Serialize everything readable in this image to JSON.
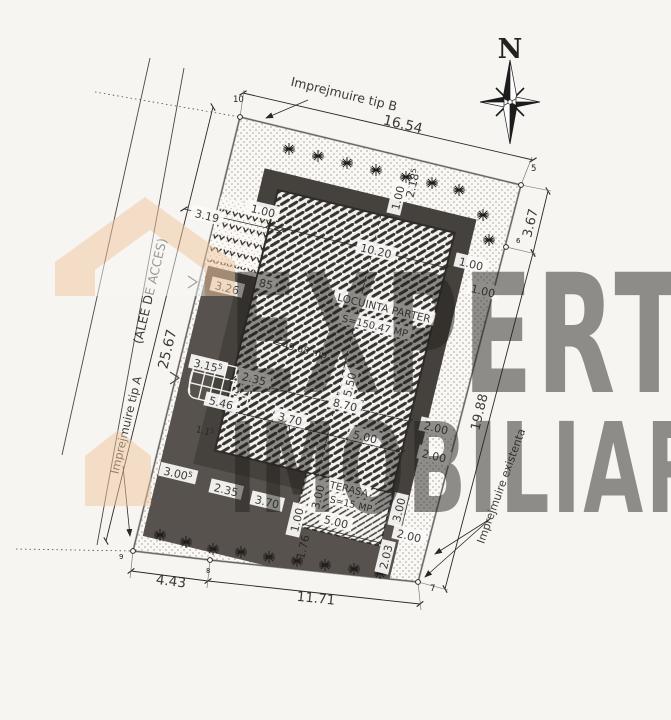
{
  "watermark": {
    "line1": "EXPERT",
    "line2": "IMOBILIAR",
    "color": "#eec49c"
  },
  "compass": {
    "north_label": "N"
  },
  "plan": {
    "building": {
      "name": "LOCUINTA PARTER",
      "area_label": "S=150.47 MP"
    },
    "terrace": {
      "name": "TERASA",
      "area_label": "S=15 MP"
    },
    "labels": [
      {
        "n": "dim-16-54",
        "t": "16.54",
        "x": 403,
        "y": 124,
        "fs": 14
      },
      {
        "n": "label-fence-b",
        "t": "Imprejmuire tip B",
        "x": 344,
        "y": 94,
        "fs": 12.5
      },
      {
        "n": "dim-25-67",
        "t": "25.67",
        "x": 167,
        "y": 349,
        "r": -76.5,
        "fs": 14
      },
      {
        "n": "label-alley",
        "t": "(ALEE DE ACCES)",
        "x": 150,
        "y": 291,
        "r": -76.5,
        "fs": 12.5
      },
      {
        "n": "label-fence-a",
        "t": "Imprejmuire tip A",
        "x": 126,
        "y": 425,
        "r": -76.5,
        "fs": 11.5
      },
      {
        "n": "dim-3-67",
        "t": "3.67",
        "x": 530,
        "y": 223,
        "r": -76.5,
        "fs": 13
      },
      {
        "n": "dim-19-88",
        "t": "19.88",
        "x": 479,
        "y": 412,
        "r": -76.5,
        "fs": 13
      },
      {
        "n": "label-fence-existing",
        "t": "Imprejmuire existenta",
        "x": 501,
        "y": 486,
        "r": -70,
        "fs": 11
      },
      {
        "n": "dim-4-43",
        "t": "4.43",
        "x": 171,
        "y": 581,
        "r": 7,
        "fs": 13.5
      },
      {
        "n": "dim-11-71",
        "t": "11.71",
        "x": 316,
        "y": 598,
        "r": 6,
        "fs": 13.5
      },
      {
        "n": "dim-3-19",
        "t": "3.19",
        "x": 207,
        "y": 216,
        "box": true
      },
      {
        "n": "dim-1-00-a",
        "t": "1.00",
        "x": 263,
        "y": 211,
        "box": true
      },
      {
        "n": "dim-3-26",
        "t": "3.26",
        "x": 227,
        "y": 288,
        "box": true
      },
      {
        "n": "dim-0-85",
        "t": "85",
        "x": 266,
        "y": 284,
        "box": true
      },
      {
        "n": "dim-10-20",
        "t": "10.20",
        "x": 376,
        "y": 251,
        "box": true
      },
      {
        "n": "dim-1-00-b",
        "t": "1.00",
        "x": 398,
        "y": 198,
        "r": -76.5,
        "box": true
      },
      {
        "n": "dim-2-185",
        "t": "2.18",
        "sup": "5",
        "x": 413,
        "y": 183,
        "r": -76.5
      },
      {
        "n": "dim-1-00-c",
        "t": "1.00",
        "x": 471,
        "y": 264,
        "box": true
      },
      {
        "n": "dim-1-00-d",
        "t": "1.00",
        "x": 483,
        "y": 291,
        "box": true
      },
      {
        "n": "building-name",
        "t": "LOCUINTA PARTER",
        "x": 384,
        "y": 308,
        "fs": 10.5,
        "box": true
      },
      {
        "n": "building-area",
        "t": "S=150.47 MP",
        "x": 375,
        "y": 326,
        "fs": 10,
        "box": true
      },
      {
        "n": "area-faint",
        "t": "=49.68 mp",
        "x": 301,
        "y": 349,
        "fs": 9.5,
        "faint": true
      },
      {
        "n": "dim-15-50",
        "t": "15.50",
        "x": 349,
        "y": 388,
        "r": -76.5,
        "box": true
      },
      {
        "n": "dim-8-70",
        "t": "8.70",
        "x": 345,
        "y": 405,
        "box": true
      },
      {
        "n": "dim-3-70-a",
        "t": "3.70",
        "x": 290,
        "y": 419,
        "box": true
      },
      {
        "n": "dim-5-00-a",
        "t": "5.00",
        "x": 365,
        "y": 437,
        "box": true
      },
      {
        "n": "dim-2-00-a",
        "t": "2.00",
        "x": 436,
        "y": 428,
        "box": true
      },
      {
        "n": "dim-2-00-b",
        "t": "2.00",
        "x": 434,
        "y": 456,
        "box": true
      },
      {
        "n": "terrace-name",
        "t": "TERASA",
        "x": 349,
        "y": 489,
        "fs": 10,
        "box": true
      },
      {
        "n": "terrace-area",
        "t": "S=15 MP",
        "x": 351,
        "y": 504,
        "fs": 9.5,
        "box": true
      },
      {
        "n": "dim-3-00-a",
        "t": "3.00",
        "x": 318,
        "y": 497,
        "r": -76.5,
        "box": true
      },
      {
        "n": "dim-3-00-b",
        "t": "3.00",
        "x": 399,
        "y": 510,
        "r": -76.5,
        "box": true
      },
      {
        "n": "dim-2-00-c",
        "t": "2.00",
        "x": 409,
        "y": 536,
        "box": true
      },
      {
        "n": "dim-5-00-b",
        "t": "5.00",
        "x": 336,
        "y": 522,
        "box": true
      },
      {
        "n": "dim-1-00-e",
        "t": "1.00",
        "x": 297,
        "y": 520,
        "r": -76.5,
        "box": true
      },
      {
        "n": "dim-1-76",
        "t": "1.76",
        "x": 303,
        "y": 547,
        "r": -76.5
      },
      {
        "n": "dim-2-03",
        "t": "2.03",
        "x": 386,
        "y": 557,
        "r": -76.5,
        "box": true
      },
      {
        "n": "dim-2-35-a",
        "t": "2.35",
        "x": 226,
        "y": 490,
        "box": true
      },
      {
        "n": "dim-3-70-b",
        "t": "3.70",
        "x": 267,
        "y": 502,
        "box": true
      },
      {
        "n": "dim-3-155",
        "t": "3.15",
        "sup": "5",
        "x": 208,
        "y": 366,
        "box": true
      },
      {
        "n": "dim-2-35-b",
        "t": "2.35",
        "x": 254,
        "y": 379,
        "box": true
      },
      {
        "n": "dim-5-46",
        "t": "5.46",
        "x": 221,
        "y": 403,
        "box": true
      },
      {
        "n": "dim-3-005",
        "t": "3.00",
        "sup": "5",
        "x": 178,
        "y": 474,
        "box": true
      },
      {
        "n": "dim-1-15",
        "t": "1.1",
        "sup": "5",
        "x": 205,
        "y": 431,
        "fs": 9
      }
    ],
    "points": [
      {
        "n": "10",
        "x": 240,
        "y": 117,
        "lx": 233,
        "ly": 102
      },
      {
        "n": "5",
        "x": 521,
        "y": 185,
        "lx": 531,
        "ly": 171
      },
      {
        "n": "6",
        "x": 506,
        "y": 247,
        "lx": 516,
        "ly": 243,
        "fs": 7
      },
      {
        "n": "7",
        "x": 418,
        "y": 582,
        "lx": 430,
        "ly": 591
      },
      {
        "n": "8",
        "x": 210,
        "y": 560,
        "lx": 206,
        "ly": 573,
        "fs": 7
      },
      {
        "n": "9",
        "x": 133,
        "y": 551,
        "lx": 119,
        "ly": 559,
        "fs": 7
      }
    ],
    "trees": [
      [
        289,
        149
      ],
      [
        318,
        156
      ],
      [
        347,
        163
      ],
      [
        376,
        170
      ],
      [
        406,
        177
      ],
      [
        432,
        183
      ],
      [
        459,
        190
      ],
      [
        483,
        215
      ],
      [
        489,
        240
      ],
      [
        160,
        535
      ],
      [
        186,
        542
      ],
      [
        213,
        549
      ],
      [
        241,
        552
      ],
      [
        269,
        557
      ],
      [
        297,
        561
      ],
      [
        325,
        565
      ],
      [
        354,
        569
      ],
      [
        380,
        573
      ]
    ]
  }
}
